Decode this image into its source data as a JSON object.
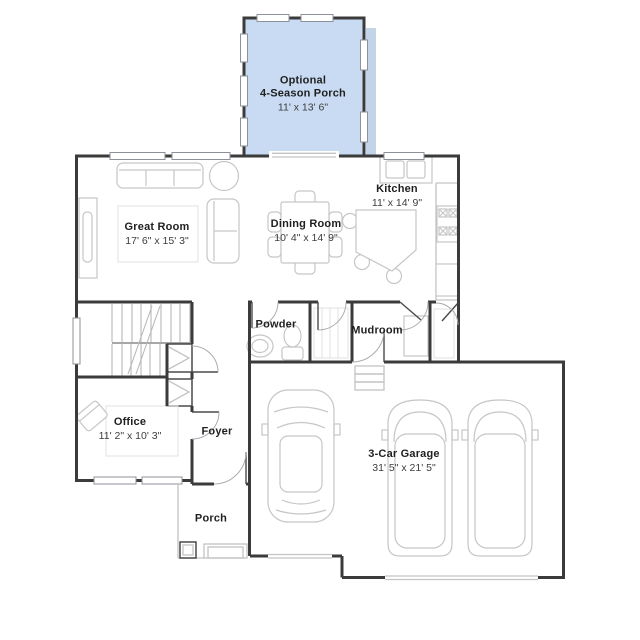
{
  "colors": {
    "background": "#ffffff",
    "wall": "#3b3b3b",
    "furniture": "#c6c6c6",
    "porch_fill": "#c9dbf3",
    "porch_shadow": "#a9c2e0",
    "text_primary": "#1f1f1f",
    "text_secondary": "#3d3d3d"
  },
  "rooms": {
    "season_porch": {
      "line1": "Optional",
      "line2": "4-Season Porch",
      "dimensions": "11' x 13' 6\""
    },
    "great_room": {
      "label": "Great Room",
      "dimensions": "17' 6\" x 15' 3\""
    },
    "dining_room": {
      "label": "Dining Room",
      "dimensions": "10' 4\" x 14' 9\""
    },
    "kitchen": {
      "label": "Kitchen",
      "dimensions": "11' x 14' 9\""
    },
    "powder": {
      "label": "Powder"
    },
    "mudroom": {
      "label": "Mudroom"
    },
    "office": {
      "label": "Office",
      "dimensions": "11' 2\" x 10' 3\""
    },
    "foyer": {
      "label": "Foyer"
    },
    "porch": {
      "label": "Porch"
    },
    "garage": {
      "label": "3-Car Garage",
      "dimensions": "31' 5\" x 21' 5\""
    }
  }
}
